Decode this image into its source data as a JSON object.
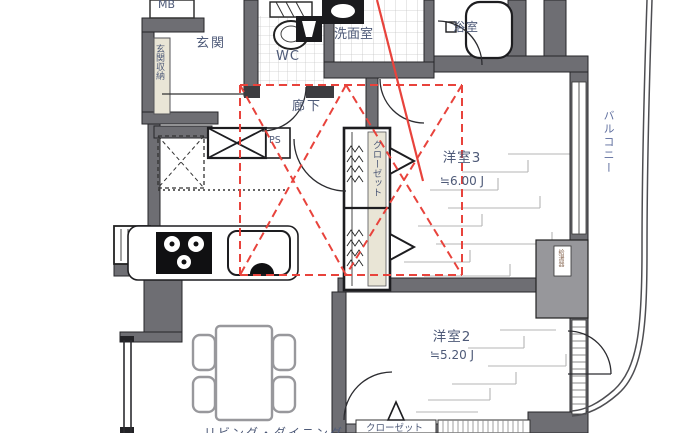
{
  "plan": {
    "rooms": {
      "mb": "MB",
      "entrance": "玄関",
      "entrance_storage": "玄関収納",
      "wc": "WC",
      "washroom": "洗面室",
      "bathroom": "浴室",
      "corridor": "廊下",
      "ps": "PS",
      "closet": "クローゼット",
      "bedroom3": "洋室3",
      "bedroom3_size": "≒6.00 J",
      "bedroom2": "洋室2",
      "bedroom2_size": "≒5.20 J",
      "balcony": "バルコニー",
      "water_heater": "給湯器",
      "closet_bottom": "クローゼット",
      "living_dining": "リビング・ダイニング"
    },
    "colors": {
      "wall_gray": "#6e6e73",
      "wall_dark": "#26262a",
      "label_blue": "#4e5a78",
      "renovation_red": "#e8433c",
      "storage_beige": "#e9e5d6",
      "tile_line": "#cbcbcb",
      "brick_line": "#b5b5b5"
    }
  }
}
